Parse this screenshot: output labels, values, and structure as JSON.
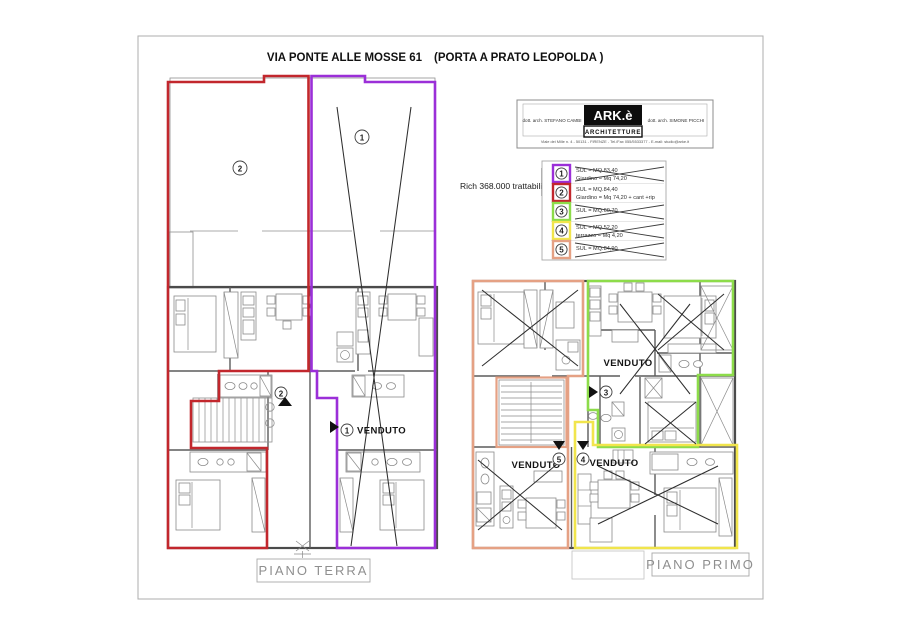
{
  "title_left": "VIA PONTE ALLE MOSSE 61",
  "title_right": "(PORTA A PRATO LEOPOLDA )",
  "price_note": "Rich 368.000 trattabili",
  "firm": {
    "logo": "ARK.è",
    "banner": "ARCHITETTURE",
    "name_left": "dott. arch. STEFANO CAMBI",
    "name_right": "dott. arch. SIMONE PICCHI",
    "address": "Viale dei Mille n. 4 - 50131 - FIRENZE - Tel./Fax 055/5533377 - E-mail: studio@arke.it"
  },
  "legend": {
    "items": [
      {
        "num": "1",
        "color": "#9b2fd8",
        "line1": "SUL = MQ.83,40",
        "line2": "Giardino = Mq 74,20",
        "crossed": true
      },
      {
        "num": "2",
        "color": "#c2272d",
        "line1": "SUL = MQ.84,40",
        "line2": "Giardino = Mq 74,20 + cant +rip",
        "crossed": false
      },
      {
        "num": "3",
        "color": "#8ddc4a",
        "line1": "SUL = MQ.60,70",
        "line2": "",
        "crossed": true
      },
      {
        "num": "4",
        "color": "#f1e54c",
        "line1": "SUL = MQ.52,20",
        "line2": "terrazzo = Mq 4,20",
        "crossed": true
      },
      {
        "num": "5",
        "color": "#e5a184",
        "line1": "SUL = MQ.84,90",
        "line2": "",
        "crossed": true
      }
    ]
  },
  "plan_terra": {
    "label": "PIANO TERRA",
    "garden1_num": "1",
    "garden2_num": "2",
    "entry1_num": "1",
    "entry2_num": "2",
    "venduto1": "VENDUTO"
  },
  "plan_primo": {
    "label": "PIANO PRIMO",
    "entry3_num": "3",
    "entry4_num": "4",
    "entry5_num": "5",
    "venduto3": "VENDUTO",
    "venduto4": "VENDUTO",
    "venduto5": "VENDUTO"
  }
}
